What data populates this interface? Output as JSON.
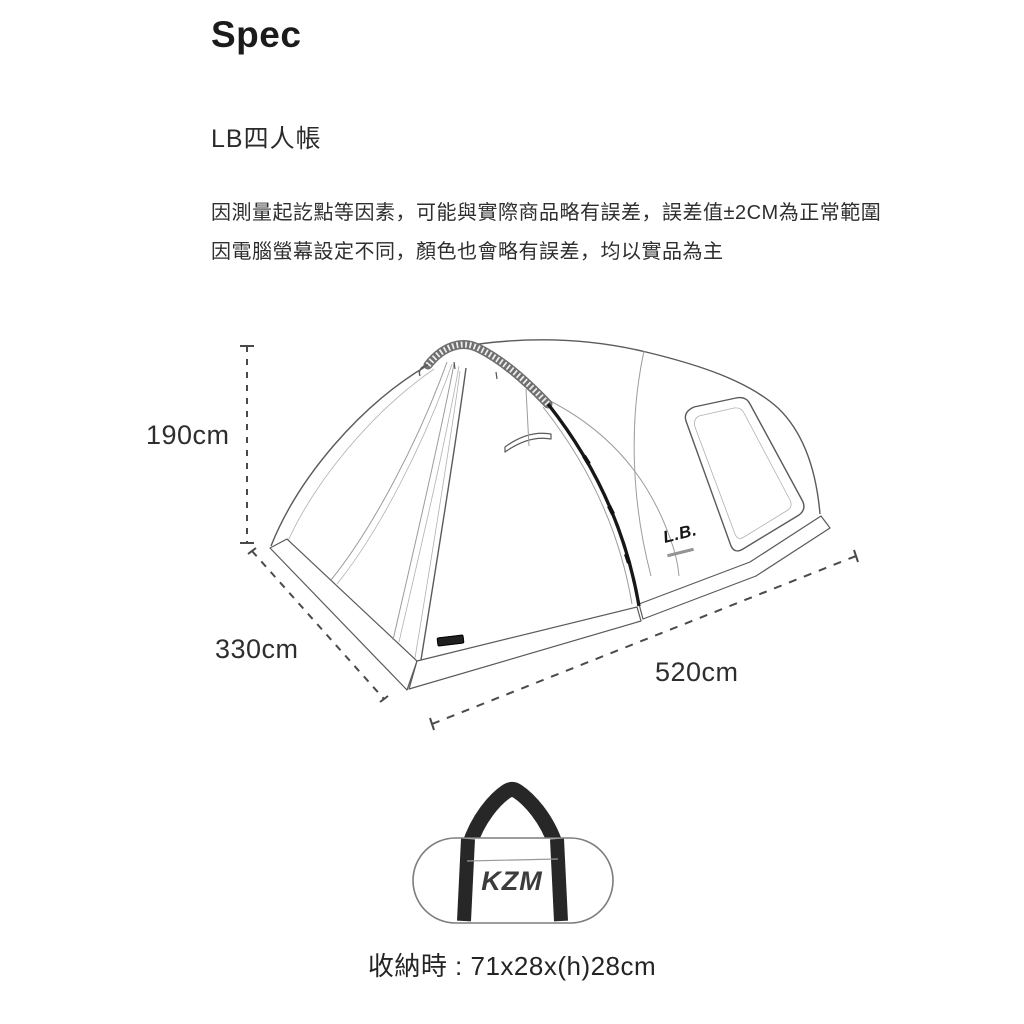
{
  "page": {
    "background": "#ffffff"
  },
  "header": {
    "title": "Spec"
  },
  "product": {
    "name": "LB四人帳"
  },
  "disclaimer": {
    "line1": "因測量起訖點等因素，可能與實際商品略有誤差，誤差值±2CM為正常範圍",
    "line2": "因電腦螢幕設定不同，顏色也會略有誤差，均以實品為主"
  },
  "diagram": {
    "type": "tent-dimension-line-drawing",
    "dimensions": {
      "height_label": "190cm",
      "depth_label": "330cm",
      "width_label": "520cm"
    },
    "tent_logo": "L.B.",
    "line_color": "#5a5a5a",
    "zipper_color": "#171717"
  },
  "storage": {
    "bag_logo": "KZM",
    "size_label": "收納時 : 71x28x(h)28cm"
  }
}
